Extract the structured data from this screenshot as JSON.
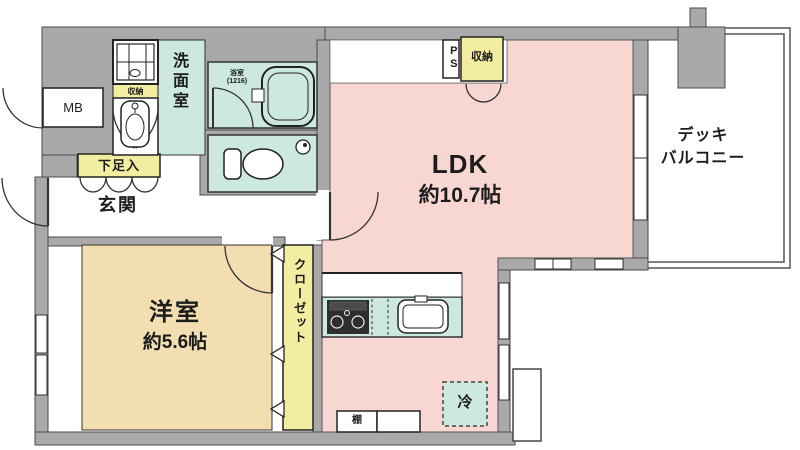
{
  "floorplan": {
    "rooms": {
      "ldk": {
        "name": "LDK",
        "area": "約10.7帖"
      },
      "western": {
        "name": "洋室",
        "area": "約5.6帖"
      },
      "entrance": {
        "name": "玄関"
      },
      "washroom": {
        "name": "洗面室"
      },
      "bathroom": {
        "name": "浴室",
        "size_code": "(1216)"
      },
      "balcony": {
        "line1": "デッキ",
        "line2": "バルコニー"
      },
      "closet": {
        "name": "クローゼット"
      }
    },
    "labels": {
      "meter_box": "MB",
      "pipe_shaft": "PS",
      "shoe_box": "下足入",
      "storage_top": "収納",
      "storage_wash": "収納",
      "fridge": "冷",
      "shelf": "棚"
    },
    "colors": {
      "wall": "#a9a9a9",
      "ldk": "#f8d7d3",
      "western": "#f2deb0",
      "wet": "#cde8de",
      "storage": "#f3eda1"
    }
  }
}
